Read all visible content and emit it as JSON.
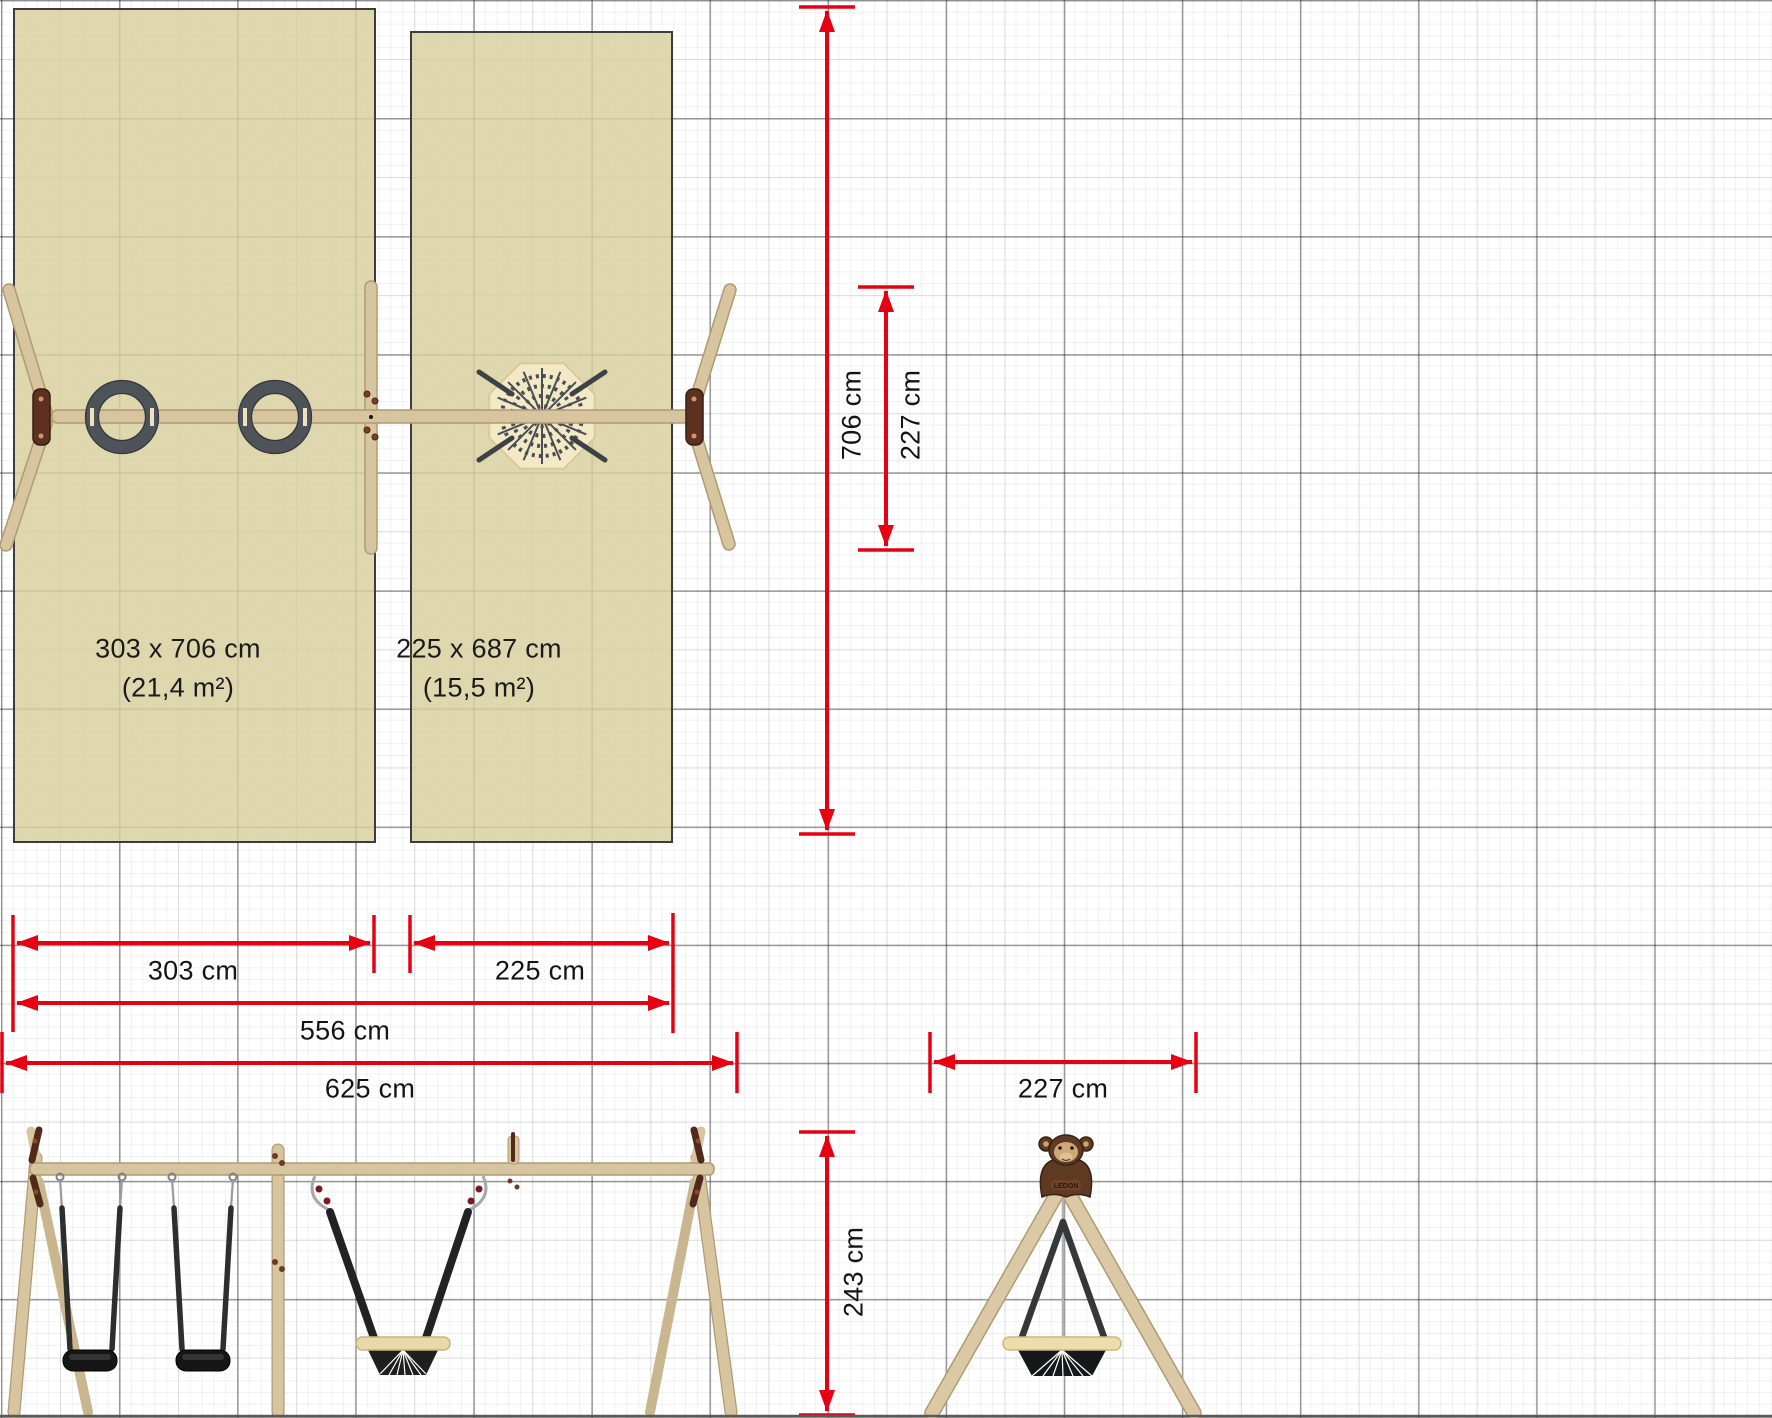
{
  "zones": {
    "left": {
      "dimensions": "303 x 706 cm",
      "area": "(21,4 m²)"
    },
    "right": {
      "dimensions": "225 x 687 cm",
      "area": "(15,5 m²)"
    }
  },
  "measurements": {
    "zone_height": "706 cm",
    "frame_depth": "227 cm",
    "left_bay_width": "303 cm",
    "right_bay_width": "225 cm",
    "beam_length": "556 cm",
    "total_width": "625 cm",
    "side_frame_width": "227 cm",
    "frame_height": "243 cm"
  },
  "brand": {
    "logo_text": "LEDON"
  },
  "colors": {
    "dimension_red": "#e60012",
    "zone_beige": "#d8cf9e",
    "wood_tan": "#d7c5a0",
    "bracket_brown": "#5d3122",
    "rope_dark": "#3a3d40",
    "seat_black": "#161616"
  }
}
